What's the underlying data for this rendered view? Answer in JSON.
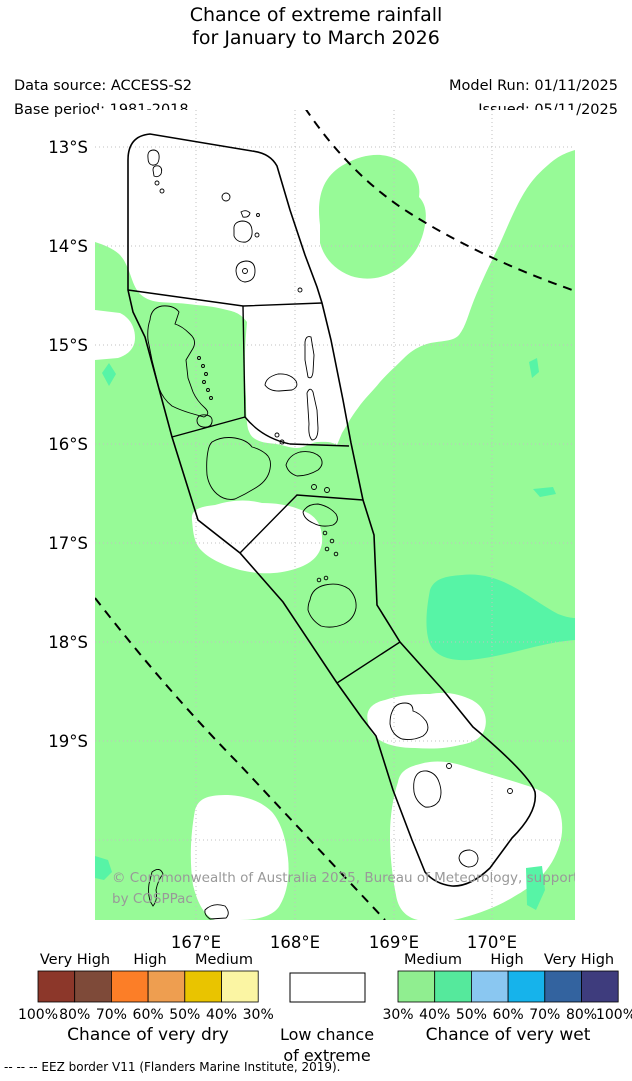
{
  "header": {
    "title_line1": "Chance of extreme rainfall",
    "title_line2": "for January to March 2026",
    "data_source": "Data source: ACCESS-S2",
    "base_period": "Base period: 1981-2018",
    "model_run": "Model Run: 01/11/2025",
    "issued": "Issued: 05/11/2025"
  },
  "map": {
    "lat_labels": [
      "13°S",
      "14°S",
      "15°S",
      "16°S",
      "17°S",
      "18°S",
      "19°S"
    ],
    "lon_labels": [
      "167°E",
      "168°E",
      "169°E",
      "170°E"
    ],
    "copyright_line1": "© Commonwealth of Australia 2025, Bureau of Meteorology, supported",
    "copyright_line2": "by COSPPac",
    "colors": {
      "wet_30_40_fill": "#97FA97",
      "wet_40_50_fill": "#57F4A6",
      "low_chance_fill": "#ffffff",
      "border": "#000000",
      "gridline": "#c0c0c0"
    }
  },
  "legend": {
    "dry": {
      "group_labels": [
        "Very High",
        "High",
        "Medium"
      ],
      "percents": [
        "100%",
        "80%",
        "70%",
        "60%",
        "50%",
        "40%",
        "30%"
      ],
      "colors": [
        "#8C372A",
        "#7E4A39",
        "#FC7E27",
        "#EE9E50",
        "#E9C400",
        "#FBF5A3"
      ],
      "caption": "Chance of very dry"
    },
    "center": {
      "line1": "Low chance",
      "line2": "of extreme",
      "color": "#ffffff"
    },
    "wet": {
      "group_labels": [
        "Medium",
        "High",
        "Very High"
      ],
      "percents": [
        "30%",
        "40%",
        "50%",
        "60%",
        "70%",
        "80%",
        "100%"
      ],
      "colors": [
        "#90EE90",
        "#55E99C",
        "#8AC7F1",
        "#16B3EB",
        "#33639F",
        "#3E3C7D"
      ],
      "caption": "Chance of very wet"
    }
  },
  "footer": {
    "eez_note": "--  --  --  EEZ border V11 (Flanders Marine Institute, 2019)."
  }
}
